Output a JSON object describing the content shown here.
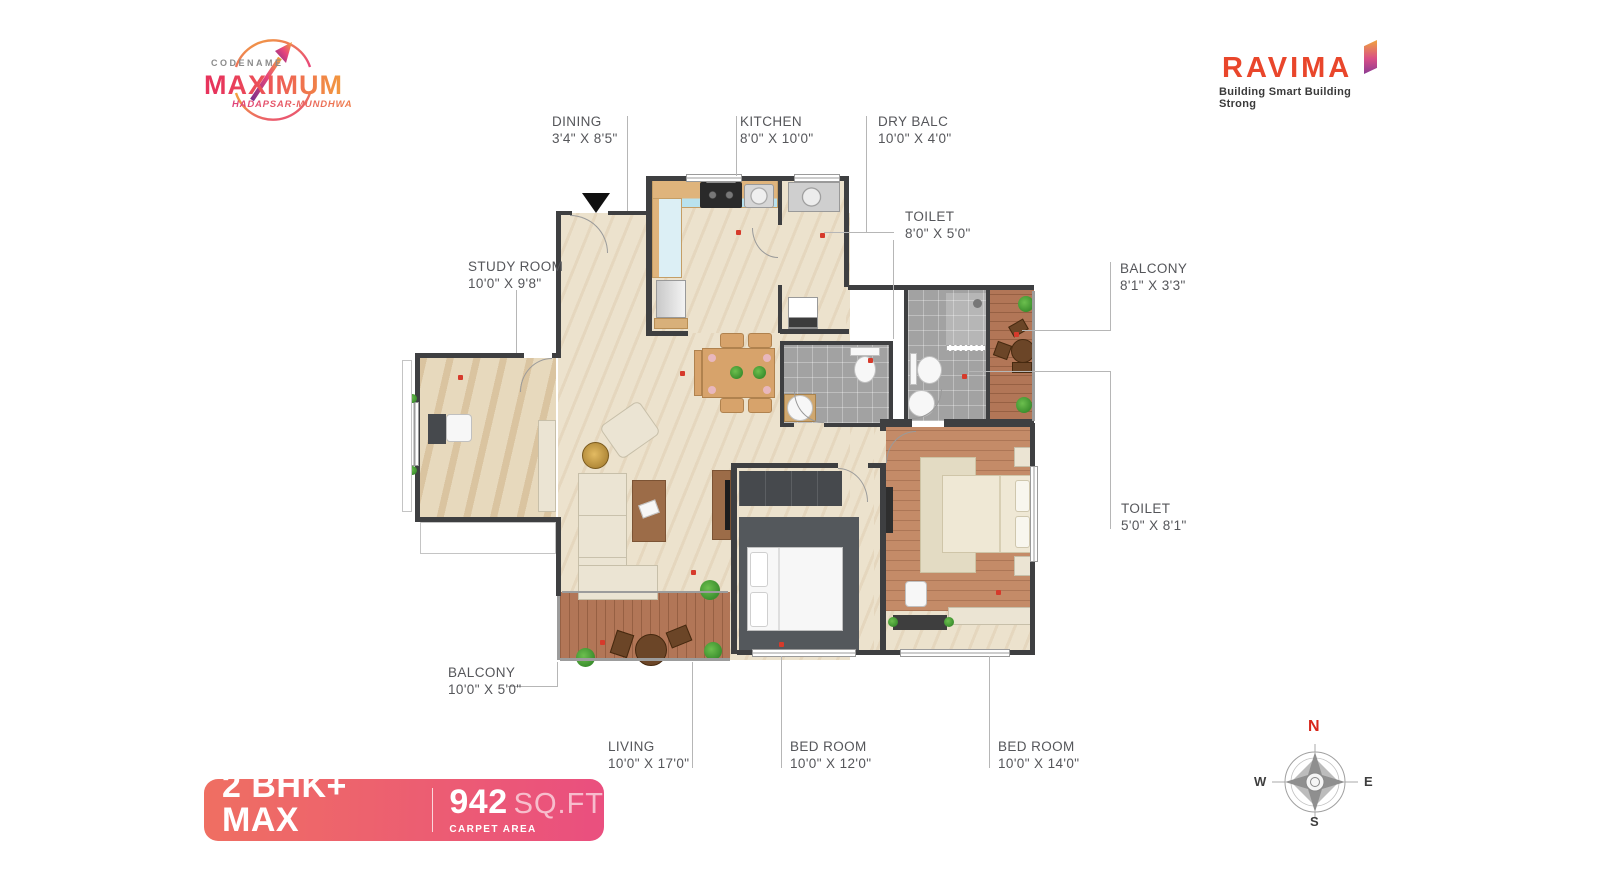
{
  "branding": {
    "codename": "CODENAME",
    "project": "MAXIMUM",
    "location": "HADAPSAR-MUNDHWA",
    "developer": "RAVIMA",
    "tagline": "Building Smart Building Strong"
  },
  "plan": {
    "rooms": [
      {
        "label": "DINING",
        "dims": "3'4\" X 8'5\""
      },
      {
        "label": "KITCHEN",
        "dims": "8'0\" X 10'0\""
      },
      {
        "label": "DRY BALC",
        "dims": "10'0\" X 4'0\""
      },
      {
        "label": "TOILET",
        "dims": "8'0\" X 5'0\""
      },
      {
        "label": "BALCONY",
        "dims": "8'1\" X 3'3\""
      },
      {
        "label": "STUDY ROOM",
        "dims": "10'0\" X 9'8\""
      },
      {
        "label": "TOILET",
        "dims": "5'0\" X 8'1\""
      },
      {
        "label": "BALCONY",
        "dims": "10'0\" X 5'0\""
      },
      {
        "label": "LIVING",
        "dims": "10'0\" X 17'0\""
      },
      {
        "label": "BED ROOM",
        "dims": "10'0\" X 12'0\""
      },
      {
        "label": "BED ROOM",
        "dims": "10'0\" X 14'0\""
      }
    ],
    "icons": {
      "entrance_marker": "filled-down-triangle",
      "compass_rose": "8-point-rose",
      "electrical_point": "red-dot"
    }
  },
  "summary": {
    "unit_type": "2 BHK+ MAX",
    "unit_sub": "TYPICAL UNIT PLAN",
    "area_value": "942",
    "area_unit": "SQ.FT",
    "area_sub": "CARPET AREA"
  },
  "compass": {
    "n": "N",
    "e": "E",
    "s": "S",
    "w": "W"
  },
  "colors": {
    "banner_gradient_start": "#ef6f62",
    "banner_gradient_end": "#ea4f7f",
    "brand_red": "#e9462b",
    "label_text": "#55565a",
    "north_red": "#d8261a",
    "wall": "#3e3f41",
    "floor_cream": "#ece2cd",
    "floor_wood": "#b27657",
    "floor_tile": "#a2a2a2"
  }
}
